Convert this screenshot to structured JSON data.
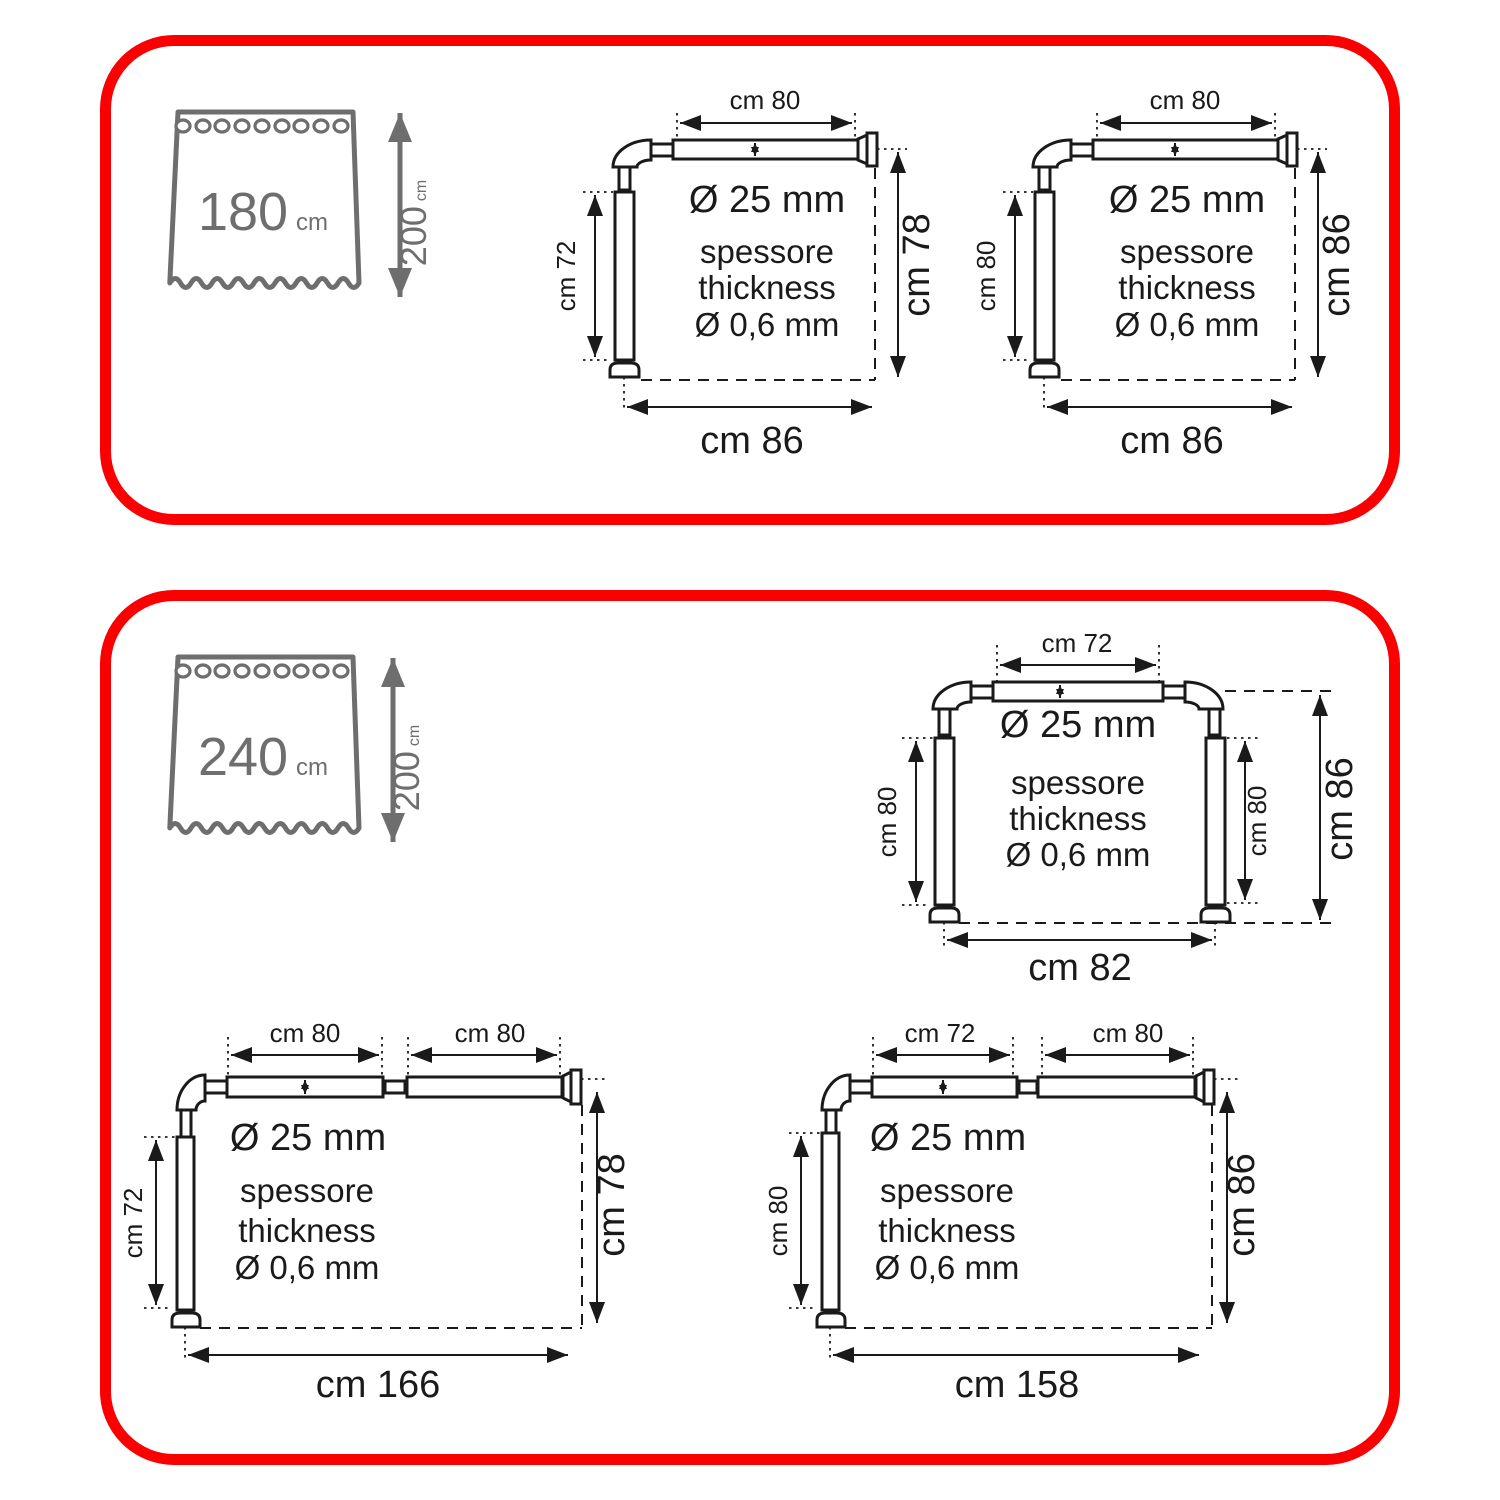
{
  "colors": {
    "panel_border": "#fa0000",
    "diagram_line": "#1a1a1a",
    "curtain_gray": "#6e6e6e"
  },
  "shared": {
    "diameter": "Ø 25 mm",
    "thickness_l1": "spessore",
    "thickness_l2": "thickness",
    "thickness_l3": "Ø 0,6 mm"
  },
  "panel_top": {
    "curtain": {
      "width": "180",
      "width_unit": "cm",
      "height": "200",
      "height_unit": "cm"
    },
    "rod_left": {
      "top": "cm 80",
      "side": "cm 72",
      "right": "cm 78",
      "bottom": "cm 86"
    },
    "rod_right": {
      "top": "cm 80",
      "side": "cm 80",
      "right": "cm 86",
      "bottom": "cm 86"
    }
  },
  "panel_bottom": {
    "curtain": {
      "width": "240",
      "width_unit": "cm",
      "height": "200",
      "height_unit": "cm"
    },
    "rod_u": {
      "top": "cm 72",
      "side_left": "cm 80",
      "side_right": "cm 80",
      "right": "cm 86",
      "bottom": "cm 82"
    },
    "rod_long_left": {
      "top1": "cm 80",
      "top2": "cm 80",
      "side": "cm 72",
      "right": "cm 78",
      "bottom": "cm 166"
    },
    "rod_long_right": {
      "top1": "cm 72",
      "top2": "cm 80",
      "side": "cm 80",
      "right": "cm 86",
      "bottom": "cm 158"
    }
  }
}
